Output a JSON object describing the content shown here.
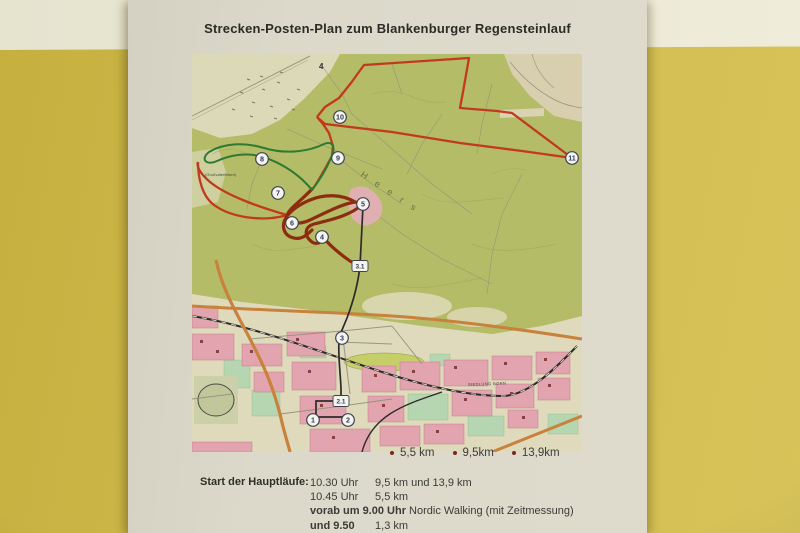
{
  "photo": {
    "colors": {
      "wall_yellow": "#d1bb4e",
      "wall_stripe_white": "#ebe8d5",
      "paper": "#dcd9cb",
      "forest_green": "#b4bc68",
      "town_cream": "#e0dabd",
      "urban_pink": "#e2a4ae",
      "route_red": "#c23a1d",
      "route_dark_red": "#8c2d10",
      "route_green": "#2e7a31",
      "route_black": "#2b2b2b",
      "road_orange": "#c8823c",
      "legend_dot": "#7b2818"
    }
  },
  "poster": {
    "title": "Strecken-Posten-Plan zum Blankenburger Regensteinlauf",
    "legend": {
      "items": [
        {
          "label": "5,5 km"
        },
        {
          "label": "9,5km"
        },
        {
          "label": "13,9km"
        }
      ]
    },
    "schedule": {
      "heading": "Start der Hauptläufe:",
      "rows": [
        {
          "t": "10.30 Uhr",
          "d": "9,5 km und 13,9 km",
          "bold": false
        },
        {
          "t": "10.45 Uhr",
          "d": "5,5 km",
          "bold": false
        },
        {
          "t": "vorab um 9.00 Uhr",
          "d": "Nordic Walking (mit Zeitmessung)",
          "bold": true
        },
        {
          "t": "und 9.50",
          "d": "1,3 km",
          "bold": true
        }
      ]
    },
    "map": {
      "checkpoints": [
        {
          "n": "10",
          "x": 148,
          "y": 63
        },
        {
          "n": "9",
          "x": 146,
          "y": 104
        },
        {
          "n": "8",
          "x": 70,
          "y": 105
        },
        {
          "n": "11",
          "x": 380,
          "y": 104
        },
        {
          "n": "7",
          "x": 86,
          "y": 139
        },
        {
          "n": "6",
          "x": 100,
          "y": 169
        },
        {
          "n": "5",
          "x": 171,
          "y": 150
        },
        {
          "n": "4",
          "x": 130,
          "y": 183
        },
        {
          "n": "3",
          "x": 150,
          "y": 284
        },
        {
          "n": "1",
          "x": 121,
          "y": 366
        },
        {
          "n": "2",
          "x": 156,
          "y": 366
        }
      ],
      "boxes": [
        {
          "n": "3.1",
          "x": 168,
          "y": 212
        },
        {
          "n": "2.1",
          "x": 149,
          "y": 347
        }
      ],
      "labels": [
        {
          "t": "4",
          "x": 127,
          "y": 15,
          "size": 8,
          "rot": 0,
          "color": "#2b2b33",
          "bold": true,
          "ls": 0
        },
        {
          "t": "Heers",
          "x": 168,
          "y": 122,
          "size": 9,
          "rot": 33,
          "color": "#6e7340",
          "bold": false,
          "ls": 10
        },
        {
          "t": "(Großvaterfelsen)",
          "x": 13,
          "y": 122,
          "size": 4,
          "rot": 0,
          "color": "#4c4c3c",
          "bold": false,
          "ls": 0
        },
        {
          "t": "SIEDLUNG BORN",
          "x": 276,
          "y": 332,
          "size": 4,
          "rot": -2,
          "color": "#3a3a35",
          "bold": false,
          "ls": 0.4
        }
      ]
    }
  }
}
